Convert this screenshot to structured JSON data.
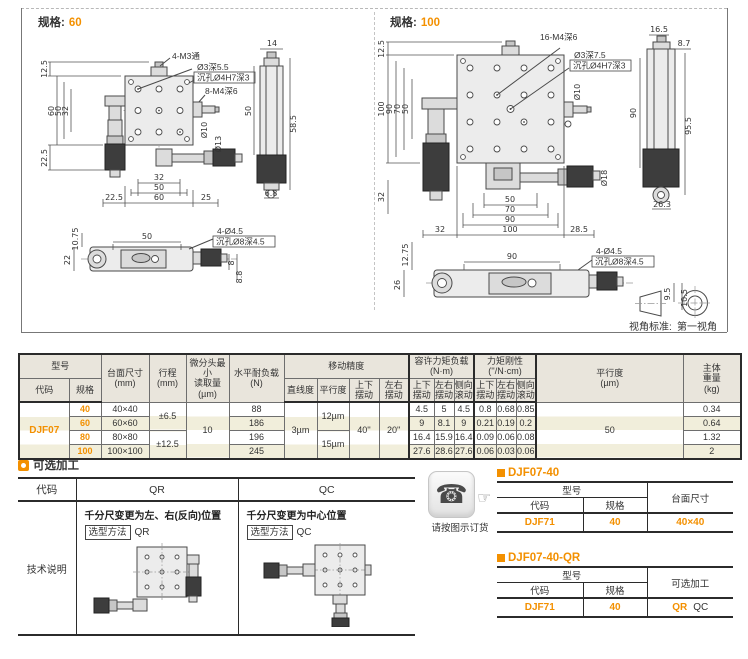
{
  "spec60": {
    "label": "规格:",
    "value": "60",
    "plan": {
      "l1": "4-M3通",
      "l2": "Ø3深5.5",
      "l3": "沉孔Ø4H7深3",
      "l4": "8-M4深6",
      "d10": "Ø10",
      "d13": "Ø13",
      "v12_5": "12.5",
      "v60": "60",
      "v50": "50",
      "v32": "32",
      "v22_5": "22.5",
      "b32": "32",
      "b50": "50",
      "b22_5": "22.5",
      "b60": "60",
      "b25": "25"
    },
    "side": {
      "v14": "14",
      "v50": "50",
      "v58_5": "58.5",
      "v6_8": "6.8"
    },
    "bottom": {
      "v10_75": "10.75",
      "v22": "22",
      "v50": "50",
      "l1": "4-Ø4.5",
      "l2": "沉孔Ø8深4.5",
      "v8": "8",
      "v8_8": "8.8"
    }
  },
  "spec100": {
    "label": "规格:",
    "value": "100",
    "plan": {
      "l1": "16-M4深6",
      "l2": "Ø3深7.5",
      "l3": "沉孔Ø4H7深3",
      "d10": "Ø10",
      "d18": "Ø18",
      "v12_5": "12.5",
      "v100": "100",
      "v90": "90",
      "v70": "70",
      "v50": "50",
      "v32": "32",
      "b50": "50",
      "b70": "70",
      "b90": "90",
      "b32": "32",
      "b100": "100",
      "b28_5": "28.5"
    },
    "side": {
      "v16_5": "16.5",
      "v8_7": "8.7",
      "v90": "90",
      "v95_5": "95.5",
      "v26_3": "26.3"
    },
    "bottom": {
      "v12_75": "12.75",
      "v26": "26",
      "v90": "90",
      "l1": "4-Ø4.5",
      "l2": "沉孔Ø8深4.5",
      "v9_5": "9.5",
      "v10_5": "10.5"
    }
  },
  "view_standard": {
    "label": "视角标准:",
    "value": "第一视角"
  },
  "main_table": {
    "h_model": "型号",
    "h_code": "代码",
    "h_spec": "规格",
    "h_size": "台面尺寸\n(mm)",
    "h_stroke": "行程\n(mm)",
    "h_micro": "微分头最小\n读取量\n(µm)",
    "h_load": "水平耐负载\n(N)",
    "h_acc": "移动精度",
    "h_straight": "直线度",
    "h_par": "平行度",
    "h_ud": "上下\n摆动",
    "h_lr": "左右\n摆动",
    "h_allow": "容许力矩负载(N·m)",
    "h_rigid": "力矩刚性(''/N·cm)",
    "h_aud": "上下\n摆动",
    "h_alr": "左右\n摆动",
    "h_aroll": "侧向\n滚动",
    "h_rud": "上下\n摆动",
    "h_rlr": "左右\n摆动",
    "h_rroll": "侧向\n滚动",
    "h_par2": "平行度\n(µm)",
    "h_weight": "主体\n重量\n(kg)",
    "model": "DJF07",
    "merged": {
      "stroke_a": "±6.5",
      "stroke_b": "±12.5",
      "micro": "10",
      "straight": "3µm",
      "par_a": "12µm",
      "par_b": "15µm",
      "ud": "40''",
      "lr": "20''",
      "par2": "50"
    },
    "rows": [
      {
        "spec": "40",
        "size": "40×40",
        "load": "88",
        "t1": "4.5",
        "t2": "5",
        "t3": "4.5",
        "r1": "0.8",
        "r2": "0.68",
        "r3": "0.85",
        "wt": "0.34"
      },
      {
        "spec": "60",
        "size": "60×60",
        "load": "186",
        "t1": "9",
        "t2": "8.1",
        "t3": "9",
        "r1": "0.21",
        "r2": "0.19",
        "r3": "0.2",
        "wt": "0.64"
      },
      {
        "spec": "80",
        "size": "80×80",
        "load": "196",
        "t1": "16.4",
        "t2": "15.9",
        "t3": "16.4",
        "r1": "0.09",
        "r2": "0.06",
        "r3": "0.08",
        "wt": "1.32"
      },
      {
        "spec": "100",
        "size": "100×100",
        "load": "245",
        "t1": "27.6",
        "t2": "28.6",
        "t3": "27.6",
        "r1": "0.06",
        "r2": "0.03",
        "r3": "0.06",
        "wt": "2"
      }
    ]
  },
  "optional": {
    "title": "可选加工",
    "h_code": "代码",
    "h_qr": "QR",
    "h_qc": "QC",
    "qr_desc": "千分尺变更为左、右(反向)位置",
    "qc_desc": "千分尺变更为中心位置",
    "method_label": "选型方法",
    "qr_val": "QR",
    "qc_val": "QC",
    "tech": "技术说明"
  },
  "order": {
    "note": "请按图示订货",
    "ex1": {
      "title": "DJF07-40",
      "h_model": "型号",
      "h_code": "代码",
      "h_spec": "规格",
      "h_size": "台面尺寸",
      "code": "DJF71",
      "spec": "40",
      "size": "40×40"
    },
    "ex2": {
      "title": "DJF07-40-QR",
      "h_model": "型号",
      "h_code": "代码",
      "h_spec": "规格",
      "h_opt": "可选加工",
      "code": "DJF71",
      "spec": "40",
      "opt1": "QR",
      "opt2": "QC"
    }
  }
}
